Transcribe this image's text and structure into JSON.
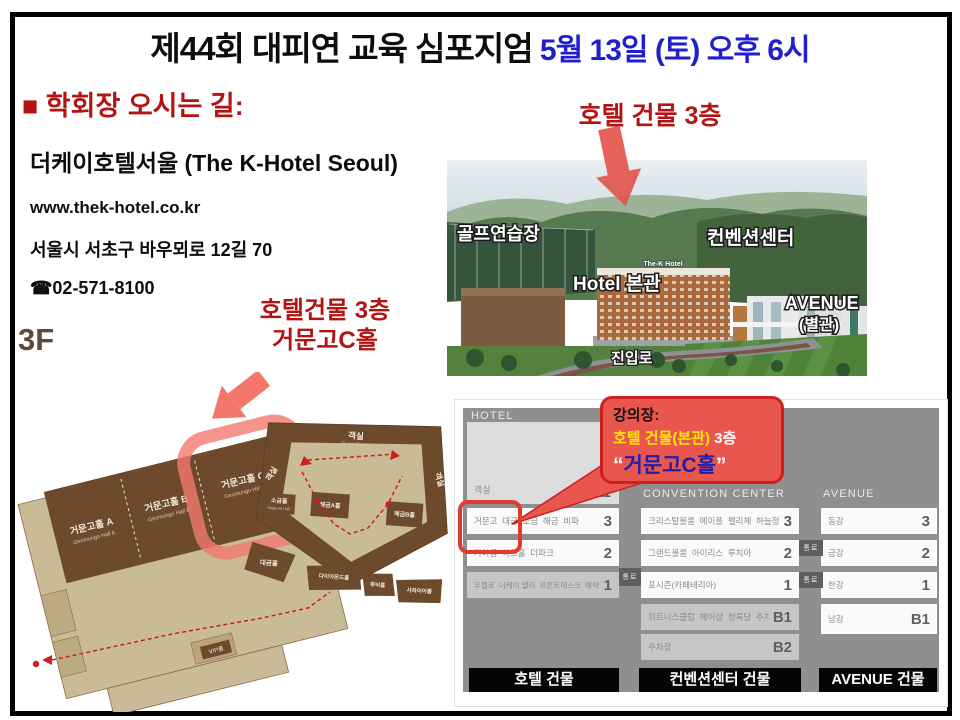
{
  "slide": {
    "title": "제44회 대피연 교육 심포지엄",
    "title_date": " 5월 13일 (토) 오후 6시",
    "section_heading": "■ 학회장 오시는 길:"
  },
  "hotel_info": {
    "name": "더케이호텔서울 (The K-Hotel Seoul)",
    "website": "www.thek-hotel.co.kr",
    "address": "서울시 서초구 바우뫼로 12길 70",
    "phone": "☎02-571-8100"
  },
  "photo": {
    "callout": "호텔 건물 3층",
    "labels": {
      "golf": "골프연습장",
      "convention": "컨벤션센터",
      "hotel_main": "Hotel 본관",
      "avenue": "AVENUE",
      "avenue_sub": "(별관)",
      "driveway": "진입로",
      "hotel_sign": "The-K Hotel"
    }
  },
  "floorplan": {
    "floor": "3F",
    "callout_line1": "호텔건물 3층",
    "callout_line2": "거문고C홀",
    "halls": {
      "geomungo_a": "거문고홀 A",
      "geomungo_a_en": "Geomungo Hall A",
      "geomungo_b": "거문고홀 B",
      "geomungo_b_en": "Geomungo Hall B",
      "geomungo_c": "거문고홀 C",
      "geomungo_c_en": "Geomungo Hall C",
      "guest_room": "객실",
      "guest_room_en": "Guest Room",
      "guest_room_left": "객실",
      "guest_room_right": "객실",
      "sogeum": "소금홀",
      "sogeum_en": "Sogeum Hall",
      "haegeum_a": "해금A홀",
      "haegeum_b": "해금B홀",
      "daegeum": "대금홀",
      "daegeum_en": "Daegeum Hall",
      "diamond": "다이아몬드홀",
      "ruby": "루비홀",
      "sapphire": "사파이어룸",
      "vip": "VIP룸"
    }
  },
  "directory": {
    "callout": {
      "line1": "강의장:",
      "line2_building": "호텔 건물(본관)",
      "line2_floor": " 3층",
      "quote_open": "“",
      "hall": "거문고C홀",
      "quote_close": "”"
    },
    "passage": "통로",
    "hotel": {
      "header": "HOTEL",
      "guest_row": {
        "names": "객실",
        "floor": "5 - 11"
      },
      "rows": [
        {
          "names": "거문고  대금  소금  해금  비파",
          "floor": "3"
        },
        {
          "names": "가야금  아트홀  더파크",
          "floor": "2"
        },
        {
          "names": "우첼로  더케이 델리  프론트데스크  예약실",
          "floor": "1"
        }
      ],
      "footer": "호텔 건물"
    },
    "convention": {
      "header": "CONVENTION CENTER",
      "rows": [
        {
          "names": "크리스탈볼룸  메이플  펠리체  하늘정원",
          "floor": "3"
        },
        {
          "names": "그랜드볼룸  아이리스  루치아",
          "floor": "2"
        },
        {
          "names": "포시즌(카페테리아)",
          "floor": "1"
        },
        {
          "names": "휘트니스클럽  헤어샵  청록당  주차장",
          "floor": "B1"
        },
        {
          "names": "주차장",
          "floor": "B2"
        }
      ],
      "footer": "컨벤션센터 건물"
    },
    "avenue": {
      "header": "AVENUE",
      "rows": [
        {
          "names": "동강",
          "floor": "3"
        },
        {
          "names": "금강",
          "floor": "2"
        },
        {
          "names": "한강",
          "floor": "1"
        },
        {
          "names": "남강",
          "floor": "B1"
        }
      ],
      "footer": "AVENUE 건물"
    }
  },
  "colors": {
    "accent_red": "#b31312",
    "title_blue": "#1f1fcf",
    "callout_red": "#e8564e",
    "plan_tan": "#c9bb97",
    "plan_brown": "#6d4a2c"
  }
}
